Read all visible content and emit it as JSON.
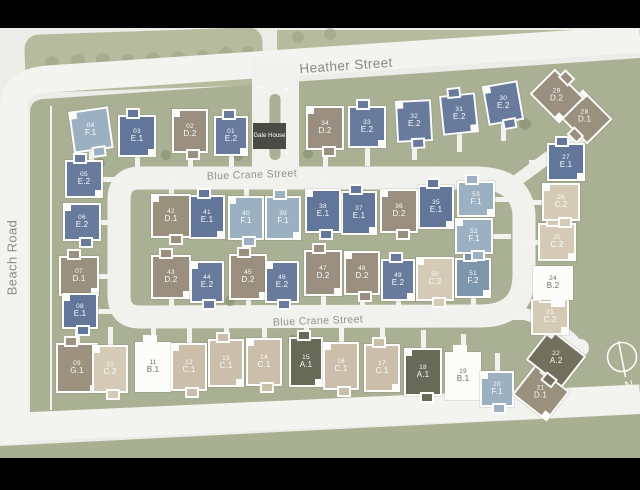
{
  "map": {
    "streets": {
      "beach_road": "Beach Road",
      "heather_street": "Heather Street",
      "blue_crane_top": "Blue Crane Street",
      "blue_crane_bottom": "Blue Crane Street"
    },
    "gate_house_label": "Gate House",
    "compass_north": "N",
    "colors": {
      "map_background": "#ecece8",
      "estate_green": "#aab094",
      "tree_strip_green": "#b6bb9e",
      "street_white": "#f2f2ee",
      "gate_house_bg": "#4b4b46",
      "types": {
        "A.1": "#676a56",
        "A.2": "#72715e",
        "B.1": "#fcfcfa",
        "B.2": "#fcfcfa",
        "C.1": "#cbbfab",
        "C.2": "#d5cab6",
        "D.1": "#99907e",
        "D.2": "#9a8e7e",
        "E.1": "#617699",
        "E.2": "#687b9d",
        "F.1": "#9bb0c1",
        "F.2": "#7e96ac",
        "G.1": "#9d917f"
      }
    },
    "dark_text_types": [
      "B.1",
      "B.2"
    ],
    "lots": [
      {
        "no": "01",
        "type": "E.2",
        "x": 231,
        "y": 136,
        "w": 34,
        "h": 40,
        "rot": 0,
        "drive": "d"
      },
      {
        "no": "02",
        "type": "D.2",
        "x": 190,
        "y": 131,
        "w": 36,
        "h": 44,
        "rot": 0,
        "drive": "d"
      },
      {
        "no": "03",
        "type": "E.1",
        "x": 137,
        "y": 136,
        "w": 38,
        "h": 42,
        "rot": 0,
        "drive": "d"
      },
      {
        "no": "04",
        "type": "F.1",
        "x": 91,
        "y": 130,
        "w": 40,
        "h": 42,
        "rot": -8,
        "drive": "d"
      },
      {
        "no": "05",
        "type": "E.2",
        "x": 84,
        "y": 179,
        "w": 38,
        "h": 38,
        "rot": 0,
        "drive": "r"
      },
      {
        "no": "06",
        "type": "E.2",
        "x": 82,
        "y": 222,
        "w": 38,
        "h": 38,
        "rot": 0,
        "drive": "r"
      },
      {
        "no": "07",
        "type": "D.1",
        "x": 79,
        "y": 276,
        "w": 40,
        "h": 40,
        "rot": 0,
        "drive": "r"
      },
      {
        "no": "08",
        "type": "E.1",
        "x": 80,
        "y": 311,
        "w": 36,
        "h": 36,
        "rot": 0,
        "drive": "r"
      },
      {
        "no": "09",
        "type": "G.1",
        "x": 77,
        "y": 368,
        "w": 42,
        "h": 50,
        "rot": 0,
        "drive": "u"
      },
      {
        "no": "10",
        "type": "C.2",
        "x": 110,
        "y": 369,
        "w": 36,
        "h": 48,
        "rot": 0,
        "drive": "u"
      },
      {
        "no": "11",
        "type": "B.1",
        "x": 153,
        "y": 367,
        "w": 36,
        "h": 50,
        "rot": 0,
        "drive": "u"
      },
      {
        "no": "12",
        "type": "C.1",
        "x": 189,
        "y": 367,
        "w": 36,
        "h": 48,
        "rot": 0,
        "drive": "u"
      },
      {
        "no": "13",
        "type": "C.1",
        "x": 226,
        "y": 363,
        "w": 36,
        "h": 48,
        "rot": 0,
        "drive": "u"
      },
      {
        "no": "14",
        "type": "C.1",
        "x": 264,
        "y": 362,
        "w": 36,
        "h": 48,
        "rot": 0,
        "drive": "u"
      },
      {
        "no": "15",
        "type": "A.1",
        "x": 306,
        "y": 362,
        "w": 34,
        "h": 50,
        "rot": 0,
        "drive": "u"
      },
      {
        "no": "16",
        "type": "C.1",
        "x": 341,
        "y": 366,
        "w": 36,
        "h": 48,
        "rot": 0,
        "drive": "u"
      },
      {
        "no": "17",
        "type": "C.1",
        "x": 382,
        "y": 368,
        "w": 36,
        "h": 48,
        "rot": 0,
        "drive": "u"
      },
      {
        "no": "18",
        "type": "A.1",
        "x": 423,
        "y": 372,
        "w": 38,
        "h": 48,
        "rot": 0,
        "drive": "u"
      },
      {
        "no": "19",
        "type": "B.1",
        "x": 463,
        "y": 376,
        "w": 36,
        "h": 48,
        "rot": 0,
        "drive": "u"
      },
      {
        "no": "20",
        "type": "F.1",
        "x": 497,
        "y": 389,
        "w": 34,
        "h": 36,
        "rot": 0,
        "drive": "u"
      },
      {
        "no": "21",
        "type": "D.1",
        "x": 541,
        "y": 393,
        "w": 44,
        "h": 38,
        "rot": 38,
        "drive": "none"
      },
      {
        "no": "22",
        "type": "A.2",
        "x": 556,
        "y": 358,
        "w": 46,
        "h": 40,
        "rot": 38,
        "drive": "none"
      },
      {
        "no": "23",
        "type": "C.2",
        "x": 550,
        "y": 317,
        "w": 38,
        "h": 36,
        "rot": 0,
        "drive": "l"
      },
      {
        "no": "24",
        "type": "B.2",
        "x": 553,
        "y": 283,
        "w": 40,
        "h": 34,
        "rot": 0,
        "drive": "l"
      },
      {
        "no": "25",
        "type": "C.2",
        "x": 557,
        "y": 242,
        "w": 38,
        "h": 38,
        "rot": 0,
        "drive": "l"
      },
      {
        "no": "26",
        "type": "C.2",
        "x": 561,
        "y": 202,
        "w": 38,
        "h": 38,
        "rot": 0,
        "drive": "l"
      },
      {
        "no": "27",
        "type": "E.1",
        "x": 566,
        "y": 162,
        "w": 38,
        "h": 38,
        "rot": 0,
        "drive": "l"
      },
      {
        "no": "28",
        "type": "D.1",
        "x": 585,
        "y": 117,
        "w": 42,
        "h": 36,
        "rot": 45,
        "drive": "none"
      },
      {
        "no": "29",
        "type": "D.2",
        "x": 557,
        "y": 96,
        "w": 42,
        "h": 36,
        "rot": 45,
        "drive": "none"
      },
      {
        "no": "30",
        "type": "E.2",
        "x": 503,
        "y": 103,
        "w": 36,
        "h": 40,
        "rot": -10,
        "drive": "d"
      },
      {
        "no": "31",
        "type": "E.2",
        "x": 459,
        "y": 114,
        "w": 36,
        "h": 40,
        "rot": -6,
        "drive": "d"
      },
      {
        "no": "32",
        "type": "E.2",
        "x": 414,
        "y": 121,
        "w": 36,
        "h": 42,
        "rot": -3,
        "drive": "d"
      },
      {
        "no": "33",
        "type": "E.2",
        "x": 367,
        "y": 127,
        "w": 38,
        "h": 42,
        "rot": 0,
        "drive": "d"
      },
      {
        "no": "34",
        "type": "D.2",
        "x": 325,
        "y": 128,
        "w": 38,
        "h": 44,
        "rot": 0,
        "drive": "d"
      },
      {
        "no": "35",
        "type": "E.1",
        "x": 436,
        "y": 207,
        "w": 36,
        "h": 44,
        "rot": 0,
        "drive": "u"
      },
      {
        "no": "36",
        "type": "D.2",
        "x": 399,
        "y": 211,
        "w": 38,
        "h": 44,
        "rot": 0,
        "drive": "u"
      },
      {
        "no": "37",
        "type": "E.1",
        "x": 359,
        "y": 213,
        "w": 36,
        "h": 44,
        "rot": 0,
        "drive": "u"
      },
      {
        "no": "38",
        "type": "E.1",
        "x": 323,
        "y": 211,
        "w": 36,
        "h": 44,
        "rot": 0,
        "drive": "u"
      },
      {
        "no": "39",
        "type": "F.1",
        "x": 283,
        "y": 218,
        "w": 36,
        "h": 44,
        "rot": 0,
        "drive": "u"
      },
      {
        "no": "40",
        "type": "F.1",
        "x": 246,
        "y": 218,
        "w": 36,
        "h": 44,
        "rot": 0,
        "drive": "u"
      },
      {
        "no": "41",
        "type": "E.1",
        "x": 207,
        "y": 217,
        "w": 36,
        "h": 44,
        "rot": 0,
        "drive": "u"
      },
      {
        "no": "42",
        "type": "D.1",
        "x": 171,
        "y": 216,
        "w": 40,
        "h": 44,
        "rot": 0,
        "drive": "u"
      },
      {
        "no": "43",
        "type": "D.2",
        "x": 171,
        "y": 277,
        "w": 40,
        "h": 44,
        "rot": 0,
        "drive": "d"
      },
      {
        "no": "44",
        "type": "E.2",
        "x": 207,
        "y": 282,
        "w": 34,
        "h": 42,
        "rot": 0,
        "drive": "d"
      },
      {
        "no": "45",
        "type": "D.2",
        "x": 248,
        "y": 277,
        "w": 38,
        "h": 46,
        "rot": 0,
        "drive": "d"
      },
      {
        "no": "46",
        "type": "E.2",
        "x": 282,
        "y": 282,
        "w": 34,
        "h": 42,
        "rot": 0,
        "drive": "d"
      },
      {
        "no": "47",
        "type": "D.2",
        "x": 323,
        "y": 273,
        "w": 38,
        "h": 46,
        "rot": 0,
        "drive": "d"
      },
      {
        "no": "48",
        "type": "D.2",
        "x": 362,
        "y": 273,
        "w": 36,
        "h": 44,
        "rot": 0,
        "drive": "d"
      },
      {
        "no": "49",
        "type": "E.2",
        "x": 398,
        "y": 280,
        "w": 34,
        "h": 42,
        "rot": 0,
        "drive": "d"
      },
      {
        "no": "50",
        "type": "C.2",
        "x": 435,
        "y": 279,
        "w": 38,
        "h": 44,
        "rot": 0,
        "drive": "d"
      },
      {
        "no": "51",
        "type": "F.2",
        "x": 473,
        "y": 278,
        "w": 36,
        "h": 40,
        "rot": 0,
        "drive": "d"
      },
      {
        "no": "52",
        "type": "F.1",
        "x": 474,
        "y": 236,
        "w": 38,
        "h": 36,
        "rot": 0,
        "drive": "r"
      },
      {
        "no": "53",
        "type": "F.1",
        "x": 476,
        "y": 199,
        "w": 38,
        "h": 36,
        "rot": 0,
        "drive": "r"
      }
    ]
  }
}
